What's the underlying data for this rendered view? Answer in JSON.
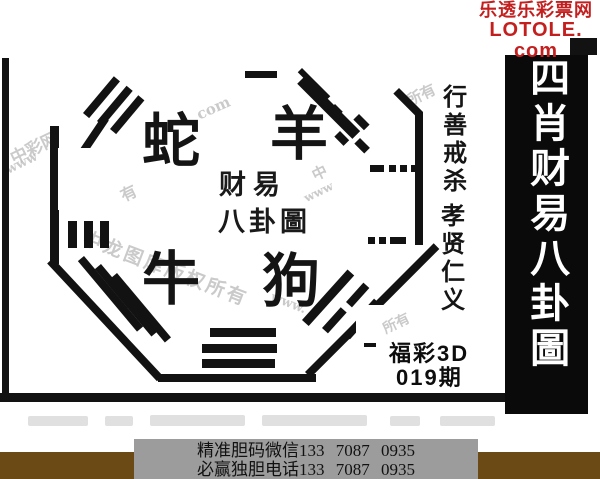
{
  "brand": {
    "site_name": "乐透乐彩票网",
    "site_url": "LOTOLE. com"
  },
  "side_banner": {
    "title": "四肖财易八卦圖"
  },
  "diagram": {
    "zodiac": {
      "top_left": "蛇",
      "top_right": "羊",
      "bottom_left": "牛",
      "bottom_right": "狗"
    },
    "center_line1": "财易",
    "center_line2": "八卦圖",
    "motto_top": "行善戒杀",
    "motto_bottom": "孝贤仁义",
    "lottery_name": "福彩3D",
    "issue": "019期"
  },
  "watermarks": {
    "w0": "中彩网",
    "w1": "www",
    "w2": "com",
    "w3": "中",
    "w4": "所有",
    "w5": "中龙图库版权所有",
    "w6": "所有",
    "w7": "www",
    "w8": "有",
    "w9": "www."
  },
  "footer": {
    "line1": "精准胆码微信133 7087 0935",
    "line2": "必赢独胆电话133 7087 0935"
  },
  "colors": {
    "brand_red": "#c41f1f",
    "ink": "#111111",
    "band_brown": "#6b4a16",
    "footer_gray": "#9c9c9c",
    "watermark_gray": "#bdbdbd"
  }
}
